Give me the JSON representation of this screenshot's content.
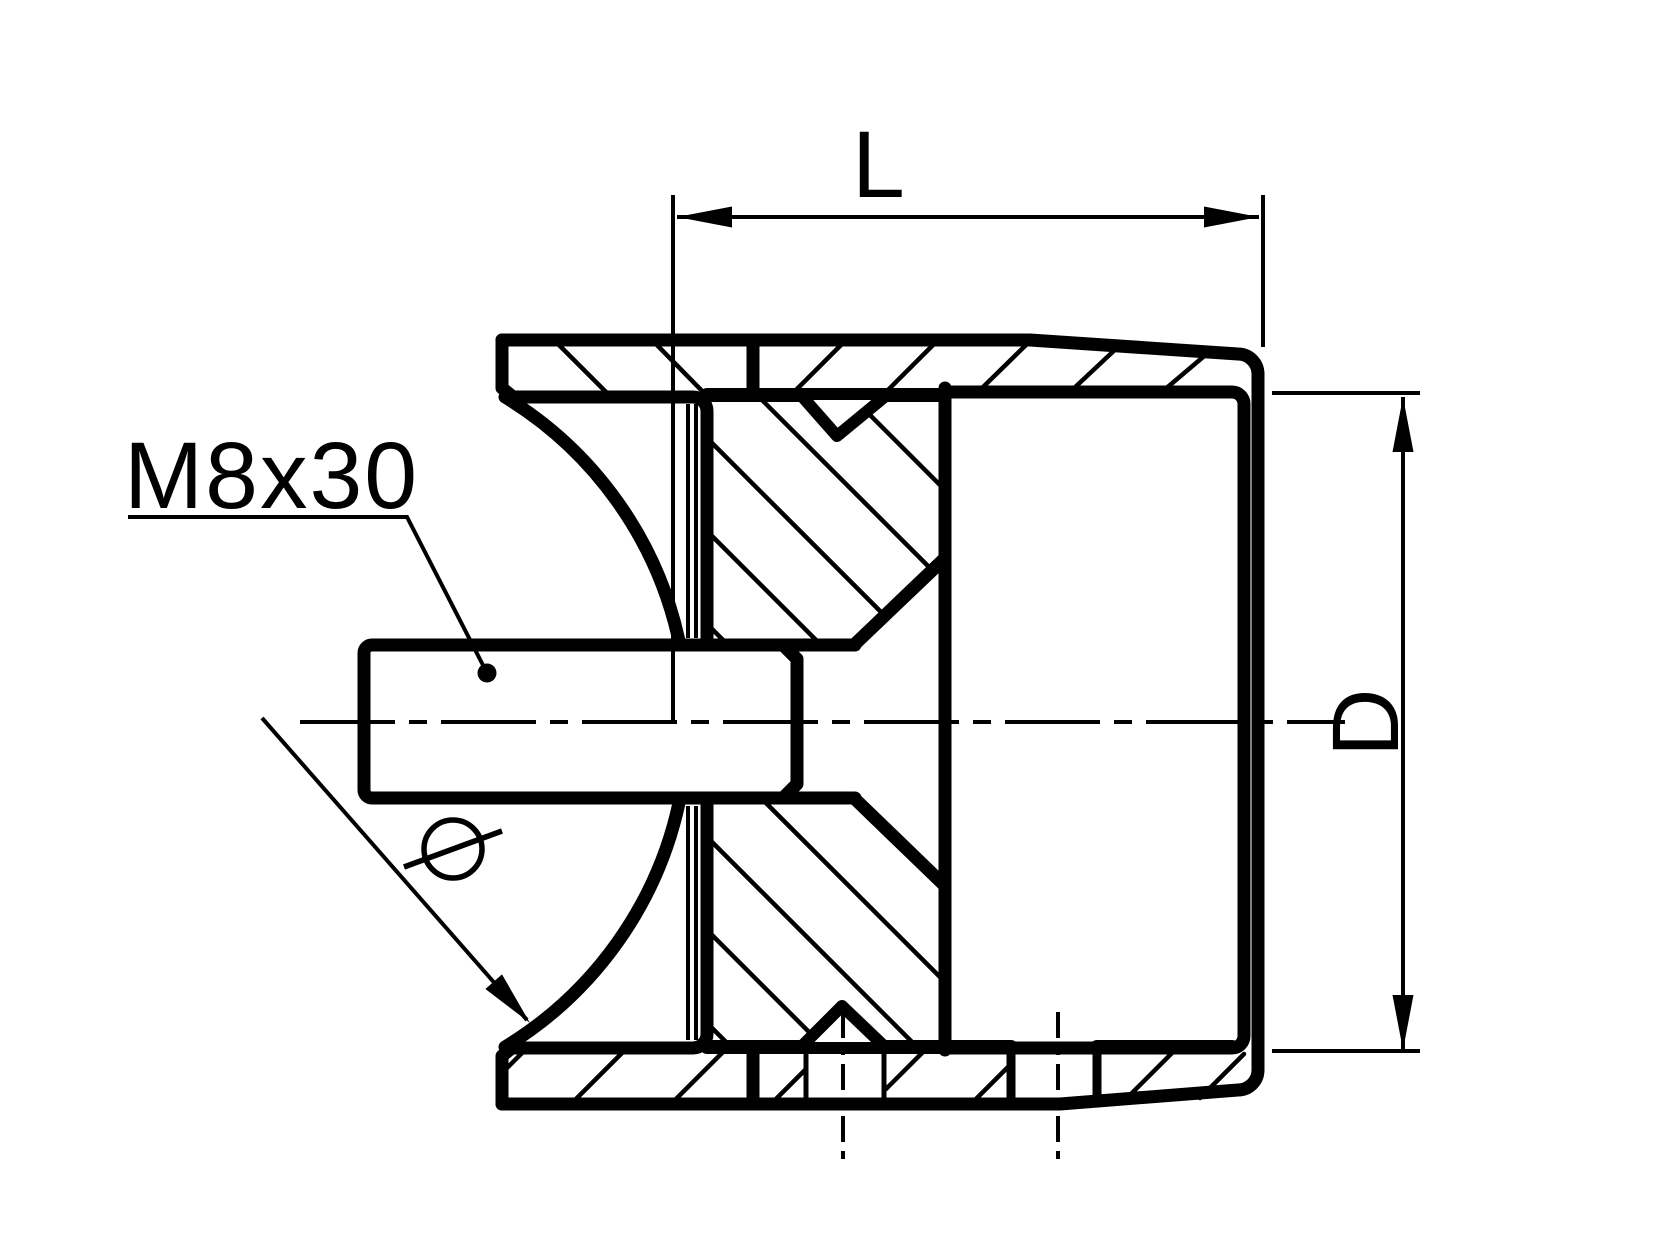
{
  "drawing": {
    "type": "engineering-section-drawing",
    "description": "Cross-section of a round-post tube adapter with saddle face, clamping bolt and end cap",
    "labels": {
      "length_dim": "L",
      "diameter_dim": "D",
      "bolt_callout": "M8x30",
      "diameter_symbol": "Ø"
    },
    "colors": {
      "line": "#000000",
      "background": "#ffffff"
    }
  }
}
